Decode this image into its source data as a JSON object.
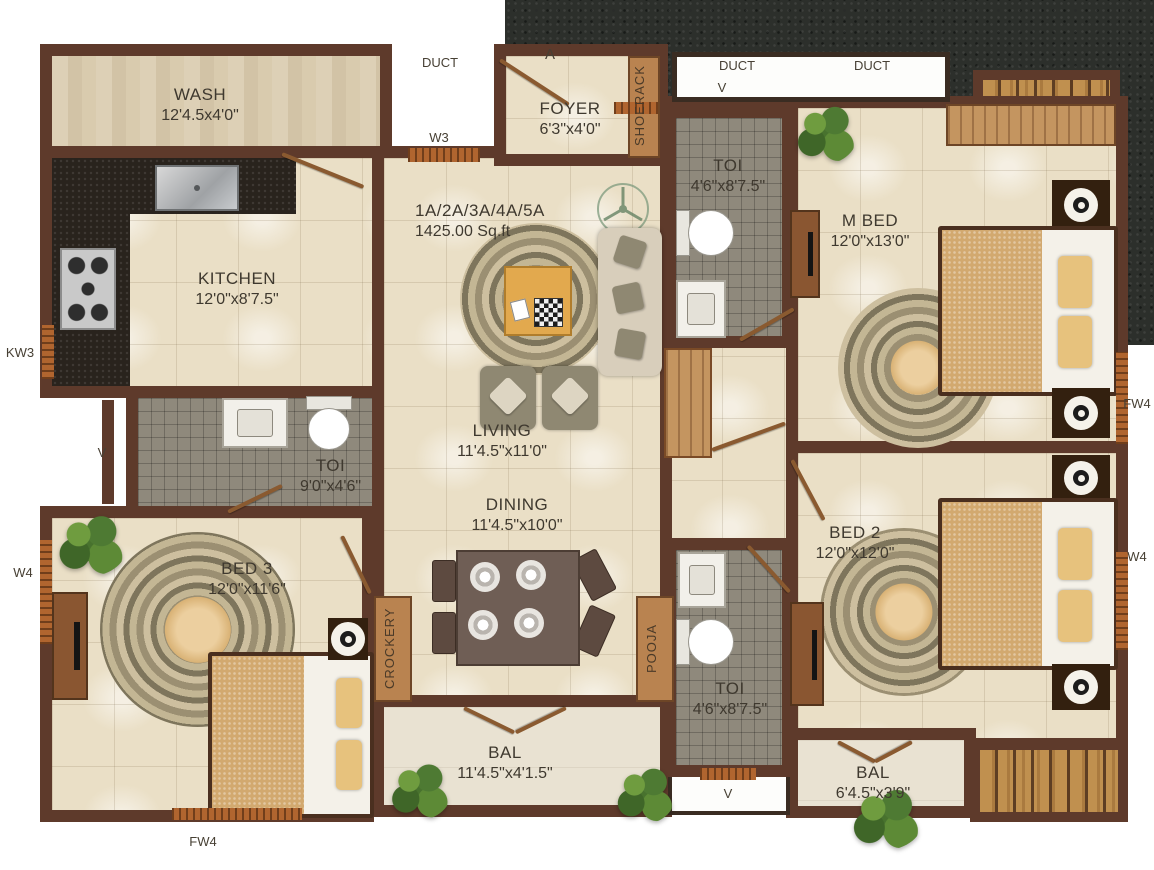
{
  "unit": {
    "code": "1A/2A/3A/4A/5A",
    "area": "1425.00 Sq.ft"
  },
  "rooms": {
    "wash": {
      "name": "WASH",
      "dims": "12'4.5x4'0\""
    },
    "kitchen": {
      "name": "KITCHEN",
      "dims": "12'0\"x8'7.5\""
    },
    "foyer": {
      "name": "FOYER",
      "dims": "6'3\"x4'0\""
    },
    "toi_top": {
      "name": "TOI",
      "dims": "4'6\"x8'7.5\""
    },
    "mbed": {
      "name": "M BED",
      "dims": "12'0\"x13'0\""
    },
    "living": {
      "name": "LIVING",
      "dims": "11'4.5\"x11'0\""
    },
    "dining": {
      "name": "DINING",
      "dims": "11'4.5\"x10'0\""
    },
    "toi_left": {
      "name": "TOI",
      "dims": "9'0\"x4'6\""
    },
    "bed3": {
      "name": "BED 3",
      "dims": "12'0\"x11'6\""
    },
    "bed2": {
      "name": "BED 2",
      "dims": "12'0\"x12'0\""
    },
    "toi_bottom": {
      "name": "TOI",
      "dims": "4'6\"x8'7.5\""
    },
    "bal_main": {
      "name": "BAL",
      "dims": "11'4.5\"x4'1.5\""
    },
    "bal_small": {
      "name": "BAL",
      "dims": "6'4.5\"x3'9\""
    }
  },
  "features": {
    "shoerack": "SHOERACK",
    "crockery": "CROCKERY",
    "pooja": "POOJA",
    "duct_left": "DUCT",
    "duct_top_1": "DUCT",
    "duct_top_2": "DUCT"
  },
  "markers": {
    "entry": "A",
    "w3": "W3",
    "kw3": "KW3",
    "w4_left": "W4",
    "w4_right": "W4",
    "fw4_right": "FW4",
    "fw4_bottom": "FW4",
    "v_top": "V",
    "v_left": "V",
    "v_bottom": "V"
  },
  "colors": {
    "wall": "#5e3a2b",
    "floor_cream": "#eadfc6",
    "bath_grey": "#8f897c",
    "granite_dark": "#2c2f2b",
    "counter_black": "#29231d",
    "deck_wood": "#c0904f",
    "window_wood": "#b0652f",
    "rug": "#9b8f72",
    "blanket": "#d2a96f",
    "plant_green": "#4e7a33",
    "label_text": "#3f392f"
  }
}
